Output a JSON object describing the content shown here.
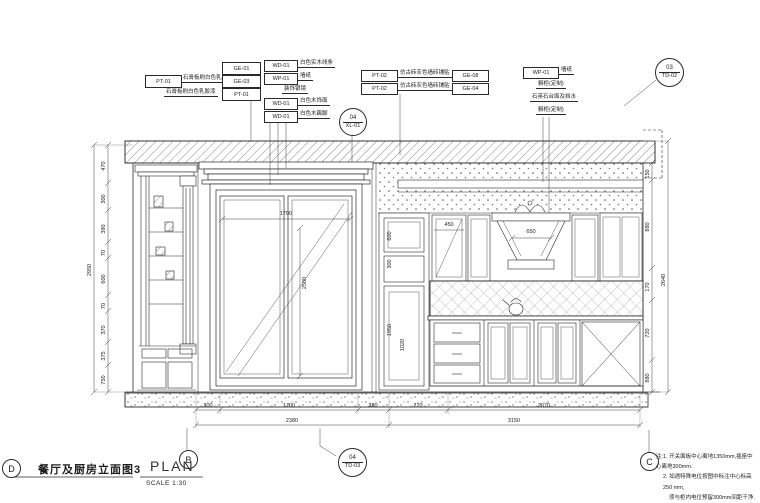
{
  "title_block": {
    "bubble": "D",
    "title": "餐厅及厨房立面图3",
    "plan": "PLAN",
    "scale": "SCALE 1:30"
  },
  "bubbles": {
    "b": "B",
    "c": "C",
    "detail_bottom": {
      "top": "04",
      "bottom": "TD-03"
    },
    "detail_mid": {
      "top": "04",
      "bottom": "XL-01"
    },
    "detail_topright": {
      "top": "03",
      "bottom": "TD-02"
    }
  },
  "tags_left": {
    "ge01": "GE-01",
    "pt01": "PT-01",
    "pt01_text": "石膏板刷白色乳胶漆",
    "ge03": "GE-03",
    "row2_text": "石膏板刷白色乳胶漆",
    "row2_code": "PT-01"
  },
  "tags_mid": {
    "r1_code": "WD-01",
    "r1_text": "白色实木线条",
    "r2_code": "WP-01",
    "r2_text": "墙纸",
    "r3_text": "装饰银镜",
    "r4_code": "WD-01",
    "r4_text": "白色木饰面",
    "r5_code": "WD-01",
    "r5_text": "白色木踢脚"
  },
  "tags_right": {
    "r1_code": "PT-02",
    "r1_text": "仿古砖灰色墙砖铺贴",
    "r1_ge": "GE-08",
    "r2_code": "PT-02",
    "r2_text": "仿古砖灰色墙砖铺贴",
    "r2_ge": "GE-04"
  },
  "tags_far_right": {
    "r1_code": "WP-01",
    "r1_text": "墙纸",
    "r2_text": "橱柜(定制)",
    "r3_text": "石英石台面及挡水",
    "r4_text": "橱柜(定制)"
  },
  "dims": {
    "bottom_row1": [
      "300",
      "1700",
      "380",
      "720",
      "2070"
    ],
    "bottom_row2": [
      "2380",
      "3150"
    ],
    "left_chain": [
      "470",
      "300",
      "390",
      "70",
      "600",
      "70",
      "370",
      "375",
      "750"
    ],
    "left_total": "2950",
    "right_chain": [
      "150",
      "880",
      "170",
      "720",
      "880"
    ],
    "right_total": "2640",
    "door_w": "1700",
    "door_h": "2500",
    "hood_w": "650",
    "cab_w": "450",
    "tall_chain": [
      "600",
      "300",
      "1950",
      "1020"
    ]
  },
  "notes": {
    "l1": "注:1. 开关面板中心离地1350mm,插座中心离地300mm.",
    "l2": "2. 如遇特殊电位按图中标注中心标高250 mm,",
    "l3": "须与柜内电位预留300mm间距干净.",
    "l4": "3. 开关面板均由甲定."
  }
}
